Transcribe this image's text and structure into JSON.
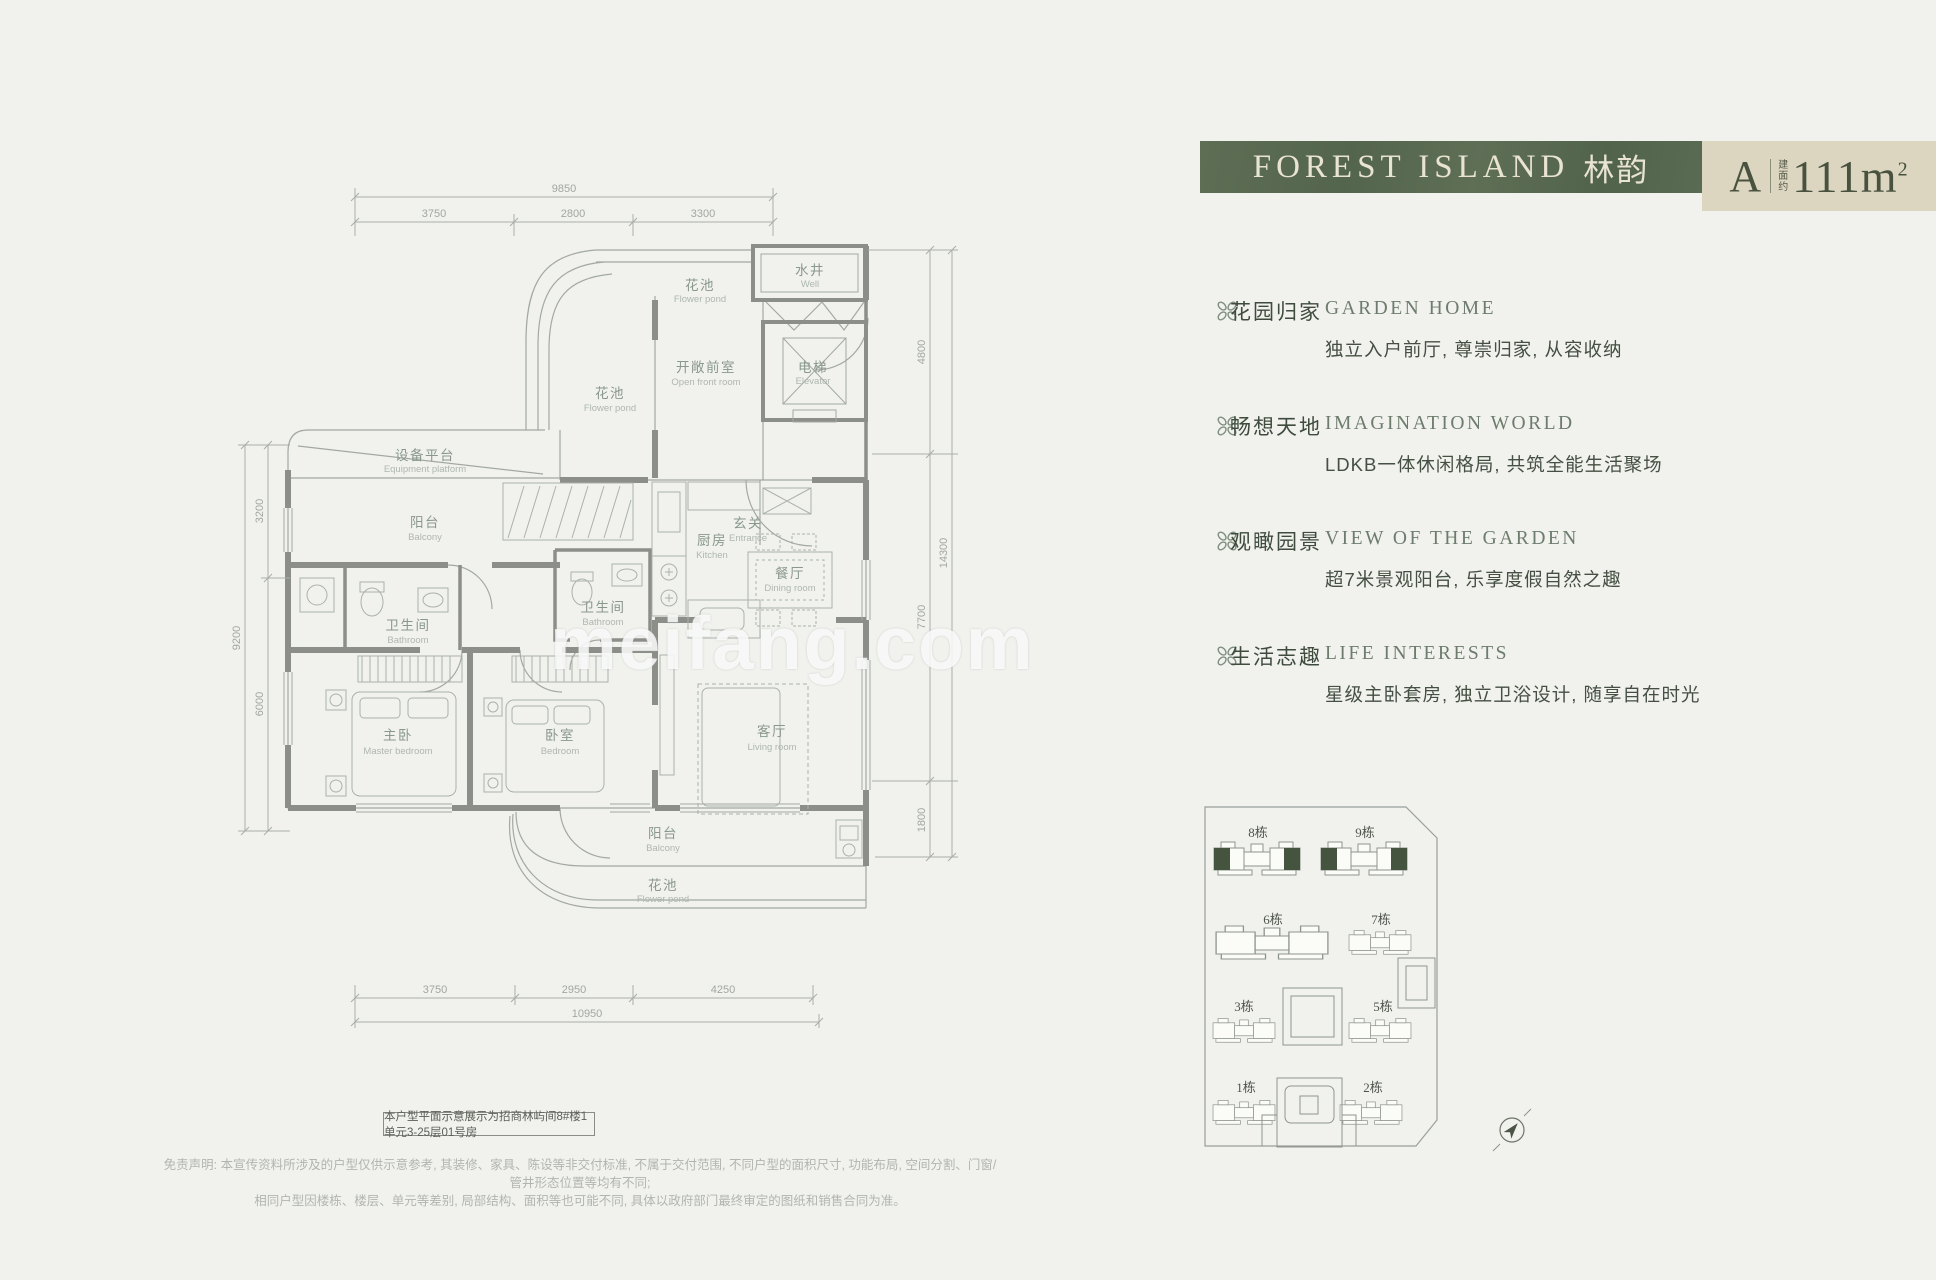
{
  "page": {
    "background": "#f1f2ee",
    "watermark": "meifang.com"
  },
  "header": {
    "title_en": "FOREST ISLAND",
    "title_cn": "林韵",
    "unit": "A",
    "area_prefix_chars": [
      "建",
      "面",
      "约"
    ],
    "area_value": "111m",
    "area_exponent": "2",
    "green_bg": "#5a6b53",
    "beige_bg": "#dcd6c1"
  },
  "features": [
    {
      "icon": "clover-flower-icon",
      "title_cn": "花园归家",
      "title_en": "GARDEN HOME",
      "desc": "独立入户前厅, 尊崇归家, 从容收纳"
    },
    {
      "icon": "clover-flower-icon",
      "title_cn": "畅想天地",
      "title_en": "IMAGINATION WORLD",
      "desc": "LDKB一体休闲格局, 共筑全能生活聚场"
    },
    {
      "icon": "clover-flower-icon",
      "title_cn": "观瞰园景",
      "title_en": "VIEW OF THE GARDEN",
      "desc": "超7米景观阳台, 乐享度假自然之趣"
    },
    {
      "icon": "clover-flower-icon",
      "title_cn": "生活志趣",
      "title_en": "LIFE INTERESTS",
      "desc": "星级主卧套房, 独立卫浴设计, 随享自在时光"
    }
  ],
  "floorplan": {
    "rooms": [
      {
        "cn": "花池",
        "en": "Flower pond"
      },
      {
        "cn": "水井",
        "en": "Well"
      },
      {
        "cn": "开敞前室",
        "en": "Open front room"
      },
      {
        "cn": "花池",
        "en": "Flower pond"
      },
      {
        "cn": "电梯",
        "en": "Elevator"
      },
      {
        "cn": "设备平台",
        "en": "Equipment platform"
      },
      {
        "cn": "阳台",
        "en": "Balcony"
      },
      {
        "cn": "卫生间",
        "en": "Bathroom"
      },
      {
        "cn": "卫生间",
        "en": "Bathroom"
      },
      {
        "cn": "厨房",
        "en": "Kitchen"
      },
      {
        "cn": "玄关",
        "en": "Entrance"
      },
      {
        "cn": "餐厅",
        "en": "Dining room"
      },
      {
        "cn": "主卧",
        "en": "Master bedroom"
      },
      {
        "cn": "卧室",
        "en": "Bedroom"
      },
      {
        "cn": "客厅",
        "en": "Living room"
      },
      {
        "cn": "阳台",
        "en": "Balcony"
      },
      {
        "cn": "花池",
        "en": "Flower pond"
      }
    ],
    "dimensions": {
      "top": {
        "total": "9850",
        "segments": [
          "3750",
          "2800",
          "3300"
        ]
      },
      "bottom": {
        "total": "10950",
        "segments": [
          "3750",
          "2950",
          "4250"
        ]
      },
      "left": {
        "total": "9200",
        "segments": [
          "3200",
          "6000"
        ]
      },
      "right": {
        "total": "14300",
        "segments": [
          "4800",
          "7700",
          "1800"
        ]
      }
    },
    "note": "本户型平面示意展示为招商林屿间8#楼1单元3-25层01号房"
  },
  "siteplan": {
    "buildings": [
      {
        "label": "8栋",
        "highlighted": true
      },
      {
        "label": "9栋",
        "highlighted": true
      },
      {
        "label": "6栋",
        "highlighted": false
      },
      {
        "label": "7栋",
        "highlighted": false
      },
      {
        "label": "3栋",
        "highlighted": false
      },
      {
        "label": "5栋",
        "highlighted": false
      },
      {
        "label": "1栋",
        "highlighted": false
      },
      {
        "label": "2栋",
        "highlighted": false
      }
    ],
    "highlight_color": "#44543f"
  },
  "disclaimer": {
    "line1": "免责声明: 本宣传资料所涉及的户型仅供示意参考, 其装修、家具、陈设等非交付标准, 不属于交付范围, 不同户型的面积尺寸, 功能布局, 空间分割、门窗/管井形态位置等均有不同;",
    "line2": "相同户型因楼栋、楼层、单元等差别, 局部结构、面积等也可能不同, 具体以政府部门最终审定的图纸和销售合同为准。"
  }
}
